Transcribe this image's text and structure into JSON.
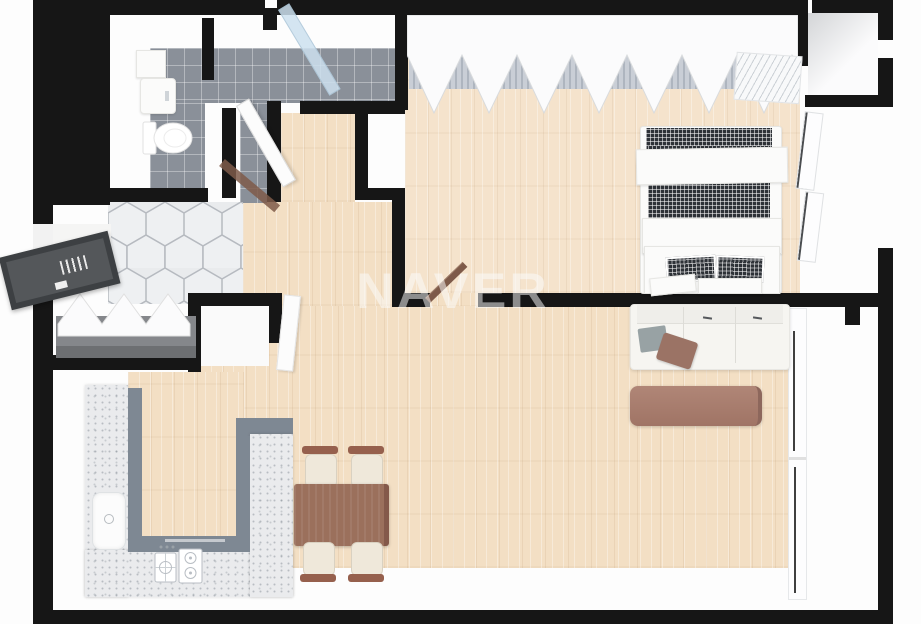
{
  "watermark": {
    "text": "NAVER"
  },
  "palette": {
    "wall": "#161616",
    "wood": "#f3dfc4",
    "wood_bedroom": "#f5e3cc",
    "tile_gray": "#8a9099",
    "hex_tile": "#eef0f2",
    "hex_grout": "#b6bac0",
    "terrazzo": "#eaebed",
    "counter_side": "#7e8893",
    "blanket_dark": "#2e3237",
    "sofa_white": "#f6f5f1",
    "table_brown": "#9b705c",
    "coffee_table": "#a87e71",
    "chair_seat": "#efe8da",
    "daybed_gray": "#85878b",
    "front_door": "#3d4043",
    "door_wood": "#7e5a49",
    "glass": "#cfe3ee"
  },
  "objects": {
    "rooms": [
      "bathroom",
      "shower",
      "entry",
      "entry-alcove",
      "storage-closet",
      "bedroom",
      "living-room",
      "kitchen",
      "dining-area",
      "balcony",
      "utility-room"
    ],
    "furniture": [
      "double-bed",
      "folding-door-wardrobe",
      "air-conditioner",
      "sofa",
      "coffee-table",
      "dining-table",
      "dining-chairs",
      "u-shaped-kitchen-counter",
      "kitchen-sink",
      "gas-stove",
      "bathroom-sink",
      "bathroom-cabinet",
      "toilet",
      "daybed",
      "entry-door",
      "bathroom-door",
      "bedroom-door",
      "shower-glass-door",
      "bedroom-windows",
      "living-room-window"
    ]
  }
}
